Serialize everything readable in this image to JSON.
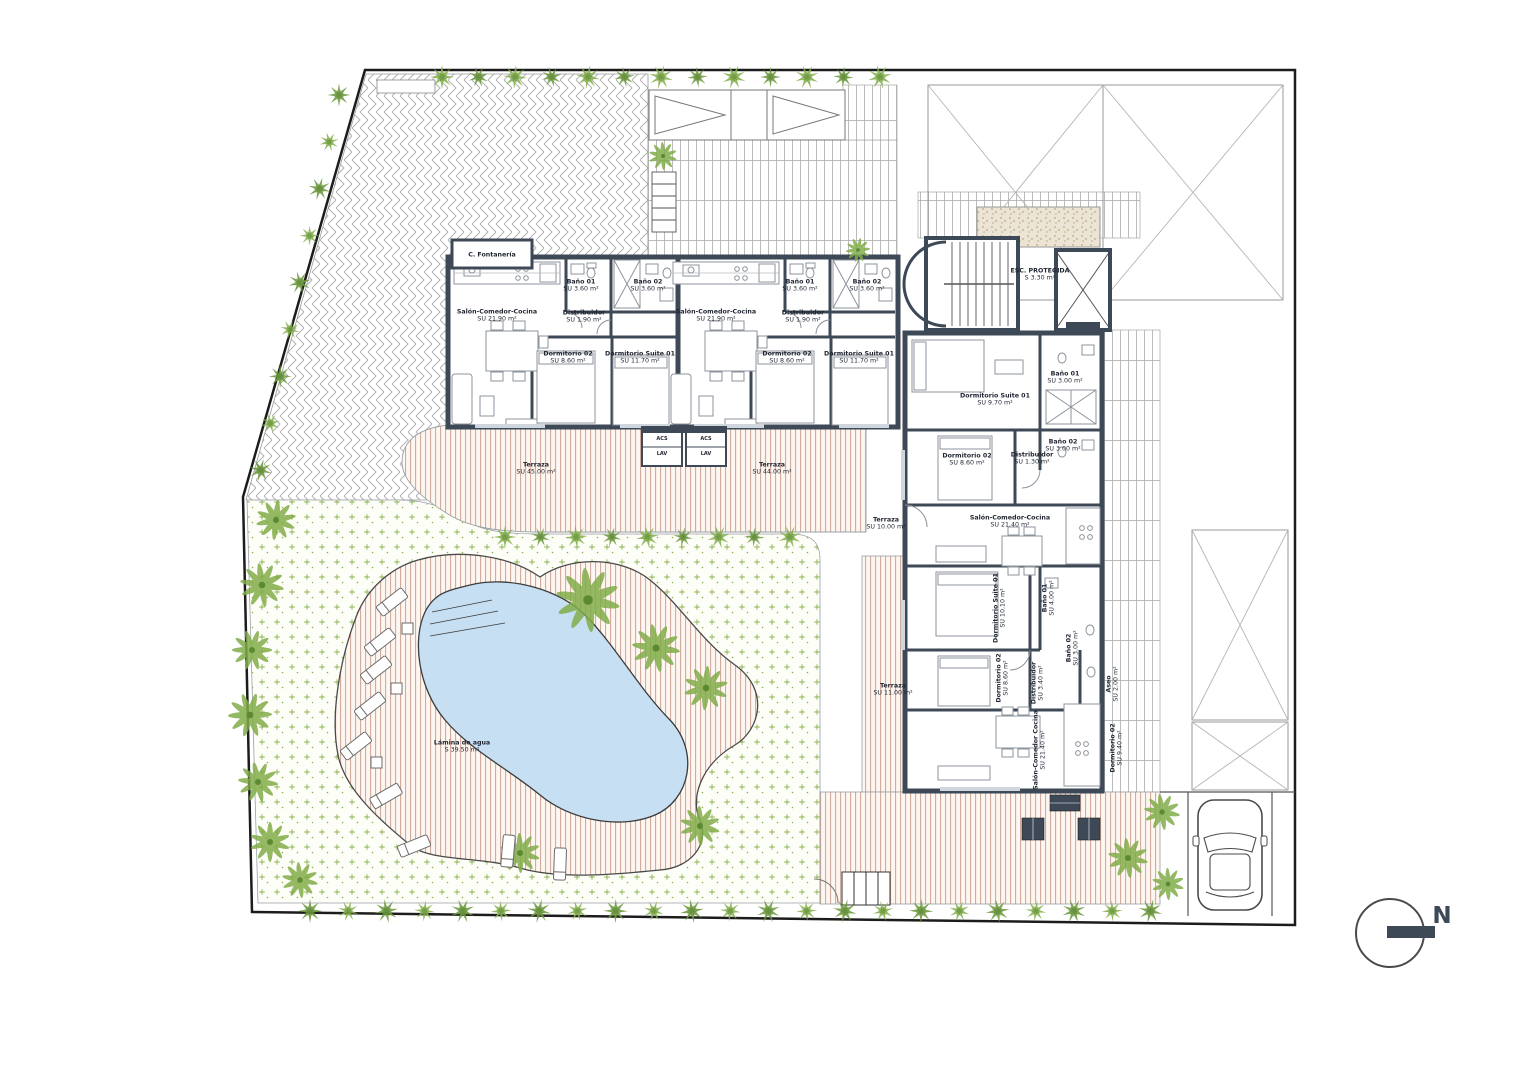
{
  "plan": {
    "north_label": "N",
    "rooms": [
      {
        "name": "Salón-Comedor-Cocina",
        "area": "SU 21.90 m²",
        "x": 497,
        "y": 316
      },
      {
        "name": "Distribuidor",
        "area": "SU 1.90 m²",
        "x": 584,
        "y": 317
      },
      {
        "name": "Baño 01",
        "area": "SU 3.60 m²",
        "x": 581,
        "y": 286
      },
      {
        "name": "Baño 02",
        "area": "SU 3.60 m²",
        "x": 648,
        "y": 286
      },
      {
        "name": "Dormitorio 02",
        "area": "SU 8.60 m²",
        "x": 568,
        "y": 358
      },
      {
        "name": "Dormitorio Suite 01",
        "area": "SU 11.70 m²",
        "x": 640,
        "y": 358
      },
      {
        "name": "Salón-Comedor-Cocina",
        "area": "SU 21.90 m²",
        "x": 716,
        "y": 316
      },
      {
        "name": "Distribuidor",
        "area": "SU 1.90 m²",
        "x": 803,
        "y": 317
      },
      {
        "name": "Baño 01",
        "area": "SU 3.60 m²",
        "x": 800,
        "y": 286
      },
      {
        "name": "Baño 02",
        "area": "SU 3.60 m²",
        "x": 867,
        "y": 286
      },
      {
        "name": "Dormitorio 02",
        "area": "SU 8.60 m²",
        "x": 787,
        "y": 358
      },
      {
        "name": "Dormitorio Suite 01",
        "area": "SU 11.70 m²",
        "x": 859,
        "y": 358
      },
      {
        "name": "ESC. PROTEGIDA",
        "area": "S 3.30 m²",
        "x": 1040,
        "y": 275
      },
      {
        "name": "Dormitorio Suite 01",
        "area": "SU 9.70 m²",
        "x": 995,
        "y": 400
      },
      {
        "name": "Baño 01",
        "area": "SU 3.00 m²",
        "x": 1065,
        "y": 378
      },
      {
        "name": "Baño 02",
        "area": "SU 3.00 m²",
        "x": 1063,
        "y": 446
      },
      {
        "name": "Distribuidor",
        "area": "SU 1.30 m²",
        "x": 1032,
        "y": 459
      },
      {
        "name": "Dormitorio 02",
        "area": "SU 8.60 m²",
        "x": 967,
        "y": 460
      },
      {
        "name": "Salón-Comedor-Cocina",
        "area": "SU 21.40 m²",
        "x": 1010,
        "y": 522
      },
      {
        "name": "Dormitorio Suite 01",
        "area": "SU 10.10 m²",
        "x": 1000,
        "y": 608,
        "rot": -90
      },
      {
        "name": "Baño 01",
        "area": "SU 4.00 m²",
        "x": 1049,
        "y": 598,
        "rot": -90
      },
      {
        "name": "Baño 02",
        "area": "SU 3.00 m²",
        "x": 1073,
        "y": 648,
        "rot": -90
      },
      {
        "name": "Dormitorio 02",
        "area": "SU 8.60 m²",
        "x": 1003,
        "y": 678,
        "rot": -90
      },
      {
        "name": "Distribuidor",
        "area": "SU 3.40 m²",
        "x": 1038,
        "y": 683,
        "rot": -90
      },
      {
        "name": "Aseo",
        "area": "SU 2.00 m²",
        "x": 1113,
        "y": 684,
        "rot": -90
      },
      {
        "name": "Salón-Comedor Cocina",
        "area": "SU 21.40 m²",
        "x": 1040,
        "y": 750,
        "rot": -90
      },
      {
        "name": "Dormitorio 02",
        "area": "SU 9.40 m²",
        "x": 1117,
        "y": 748,
        "rot": -90
      },
      {
        "name": "Terraza",
        "area": "SU 45.00 m²",
        "x": 536,
        "y": 469
      },
      {
        "name": "Terraza",
        "area": "SU 44.00 m²",
        "x": 772,
        "y": 469
      },
      {
        "name": "Terraza",
        "area": "SU 10.00 m²",
        "x": 886,
        "y": 524
      },
      {
        "name": "Terraza",
        "area": "SU 11.00 m²",
        "x": 893,
        "y": 690
      },
      {
        "name": "Lámina de agua",
        "area": "S 39.50 m²",
        "x": 462,
        "y": 747
      },
      {
        "name": "C. Fontanería",
        "area": "",
        "x": 492,
        "y": 255
      },
      {
        "name": "ACS",
        "area": "",
        "x": 662,
        "y": 440,
        "fs": 5
      },
      {
        "name": "LAV",
        "area": "",
        "x": 662,
        "y": 455,
        "fs": 5
      },
      {
        "name": "ACS",
        "area": "",
        "x": 706,
        "y": 440,
        "fs": 5
      },
      {
        "name": "LAV",
        "area": "",
        "x": 706,
        "y": 455,
        "fs": 5
      }
    ]
  },
  "colors": {
    "wall": "#3d4956",
    "boundary": "#1c1c1c",
    "pool": "#c7dff2",
    "deck_line": "#cda496",
    "lawn_green": "#8ab14e",
    "bush_green": "#86b14c",
    "bush_dark": "#6f9a3e",
    "gravel": "#ece5d6"
  }
}
